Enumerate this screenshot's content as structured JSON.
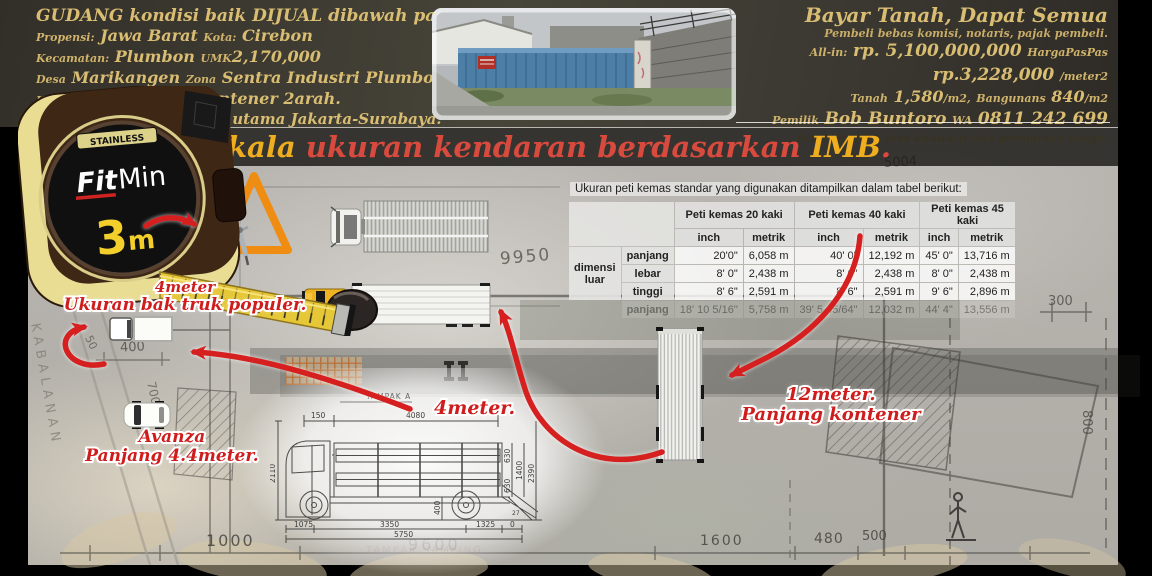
{
  "header": {
    "left": {
      "line1": "GUDANG kondisi baik DIJUAL dibawah pasaran.",
      "l2a": "Propensi:",
      "l2b": "Jawa Barat",
      "l2c": "Kota:",
      "l2d": "Cirebon",
      "l3a": "Kecamatan:",
      "l3b": "Plumbon",
      "l3c": "UMK",
      "l3d": "2,170,000",
      "l4a": "Desa",
      "l4b": "Marikangen",
      "l4c": "Zona",
      "l4d": "Sentra Industri Plumbon",
      "l5a": "Kelas Jalan III A",
      "l5b": "Jalan Kontener 2arah.",
      "line6": "1.3km dari jalan arteri utama Jakarta-Surabaya."
    },
    "right": {
      "line1": "Bayar Tanah, Dapat Semua",
      "line2": "Pembeli bebas komisi, notaris, pajak pembeli.",
      "l3a": "All-in:",
      "l3b": "rp. 5,100,000,000",
      "l3c": "HargaPasPas",
      "l4a": "rp.3,228,000",
      "l4b": "/meter2",
      "l5a": "Tanah",
      "l5b": "1,580",
      "l5c": "/m2,",
      "l5d": "Bangunans",
      "l5e": "840",
      "l5f": "/m2",
      "l6a": "Pemilik",
      "l6b": "Bob Buntoro",
      "l6c": "WA",
      "l6d": "0811 242 699",
      "line7": "Pembeli tidak bisa khawatir ada permainan harga."
    }
  },
  "title": {
    "p1": "Skala",
    "p2": " ukuran kendaran berdasarkan ",
    "p3": "IMB",
    "p4": "."
  },
  "tape": {
    "stainless": "STAINLESS",
    "fit": "Fit",
    "min": "Min",
    "size3": "3",
    "size_m": "m"
  },
  "notes": {
    "bak1": "4meter",
    "bak2": "Ukuran bak truk populer.",
    "av1": "Avanza",
    "av2": "Panjang 4.4meter.",
    "kon1": "12meter.",
    "kon2": "Panjang kontener",
    "m4": "4meter."
  },
  "table": {
    "caption": "Ukuran peti kemas standar yang digunakan ditampilkan dalam tabel berikut:",
    "groups": [
      "Peti kemas 20 kaki",
      "Peti kemas 40 kaki",
      "Peti kemas 45 kaki"
    ],
    "unit_inch": "inch",
    "unit_metric": "metrik",
    "row_group_label": "dimensi luar",
    "rows": [
      {
        "label": "panjang",
        "c1": "20'0\"",
        "c2": "6,058 m",
        "c3": "40' 0\"",
        "c4": "12,192 m",
        "c5": "45' 0\"",
        "c6": "13,716 m"
      },
      {
        "label": "lebar",
        "c1": "8' 0\"",
        "c2": "2,438 m",
        "c3": "8' 0\"",
        "c4": "2,438 m",
        "c5": "8' 0\"",
        "c6": "2,438 m"
      },
      {
        "label": "tinggi",
        "c1": "8' 6\"",
        "c2": "2,591 m",
        "c3": "8' 6\"",
        "c4": "2,591 m",
        "c5": "9' 6\"",
        "c6": "2,896 m"
      }
    ],
    "faded_row": {
      "label": "panjang",
      "c1": "18' 10 5/16\"",
      "c2": "5,758 m",
      "c3": "39' 5 45/64\"",
      "c4": "12,032 m",
      "c5": "44' 4\"",
      "c6": "13,556 m"
    }
  },
  "blueprint": {
    "dims": {
      "d9950": "9950",
      "d2200": "2200",
      "d400": "400",
      "d50": "50",
      "d700": "700",
      "d300": "300",
      "d800": "800",
      "d1000": "1000",
      "d9600": "9600",
      "d1600": "1600",
      "d480": "480",
      "d500": "500",
      "d5004": "5004"
    },
    "street": "KABALANAN",
    "tampak_faint": "TAMPAK SAMPING"
  },
  "drawing": {
    "title": "TAMPAK A",
    "d150": "150",
    "d4080": "4080",
    "d2110": "2110",
    "d630a": "630",
    "d630b": "630",
    "d1400": "1400",
    "d2390": "2390",
    "d400": "400",
    "d27": "27",
    "d1075": "1075",
    "d3350": "3350",
    "d1325": "1325",
    "d0": "0",
    "d5750": "5750"
  },
  "colors": {
    "gold": "#d9bd72",
    "annotation_red": "#cf1d1d",
    "arrow_red": "#d61f1f",
    "title_orange": "#efae1f",
    "title_red": "#d94a3e",
    "header_bg": "#3a372f",
    "blueprint_bg": "#b5b2ad",
    "tape_yellow": "#e6c737",
    "cab_yellow": "#f0b422",
    "set_square_orange": "#ef8d12",
    "table_header_bg": "#e3e3e1"
  }
}
